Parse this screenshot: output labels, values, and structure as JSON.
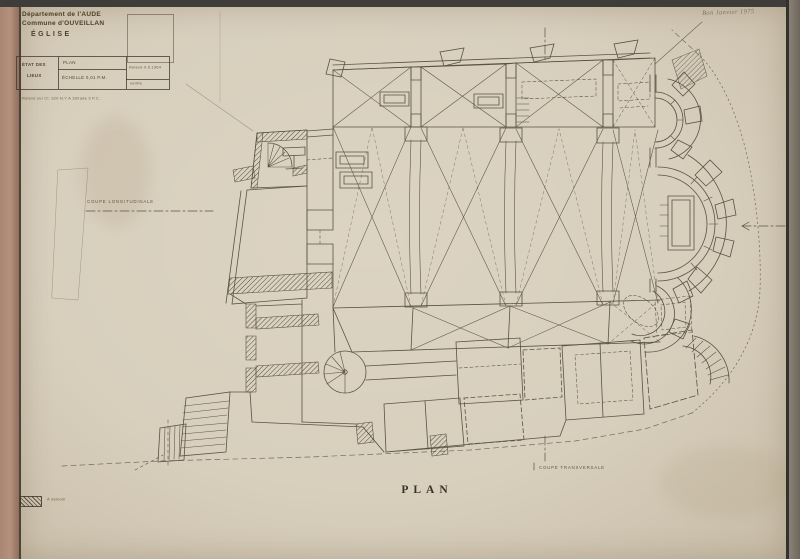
{
  "title_block": {
    "department": "Département de l'AUDE",
    "commune": "Commune d'OUVEILLAN",
    "building": "ÉGLISE",
    "table": {
      "header_line1": "ÉTAT DES",
      "header_line2": "LIEUX",
      "doc_type": "PLAN",
      "scale": "ÉCHELLE 0,01 P.M.",
      "date_note": "Relevé 9.6.1964",
      "verify_note": "vérifié"
    },
    "reference_note": "Relevé sur Cl. 320 N.Y A 18/rade 3 P.C."
  },
  "annotations": {
    "handwritten_note": "Bon Janvier 1975",
    "section_longitudinale": "COUPE LONGITUDINALE",
    "section_transversale": "COUPE TRANSVERSALE",
    "drawing_title": "PLAN",
    "legend_label": "À démolir"
  },
  "colors": {
    "paper": "#d8cfbd",
    "ink": "#4a4334",
    "mount": "#b0907d",
    "frame": "#3f3d39",
    "edge_strip": "#7d7568"
  }
}
